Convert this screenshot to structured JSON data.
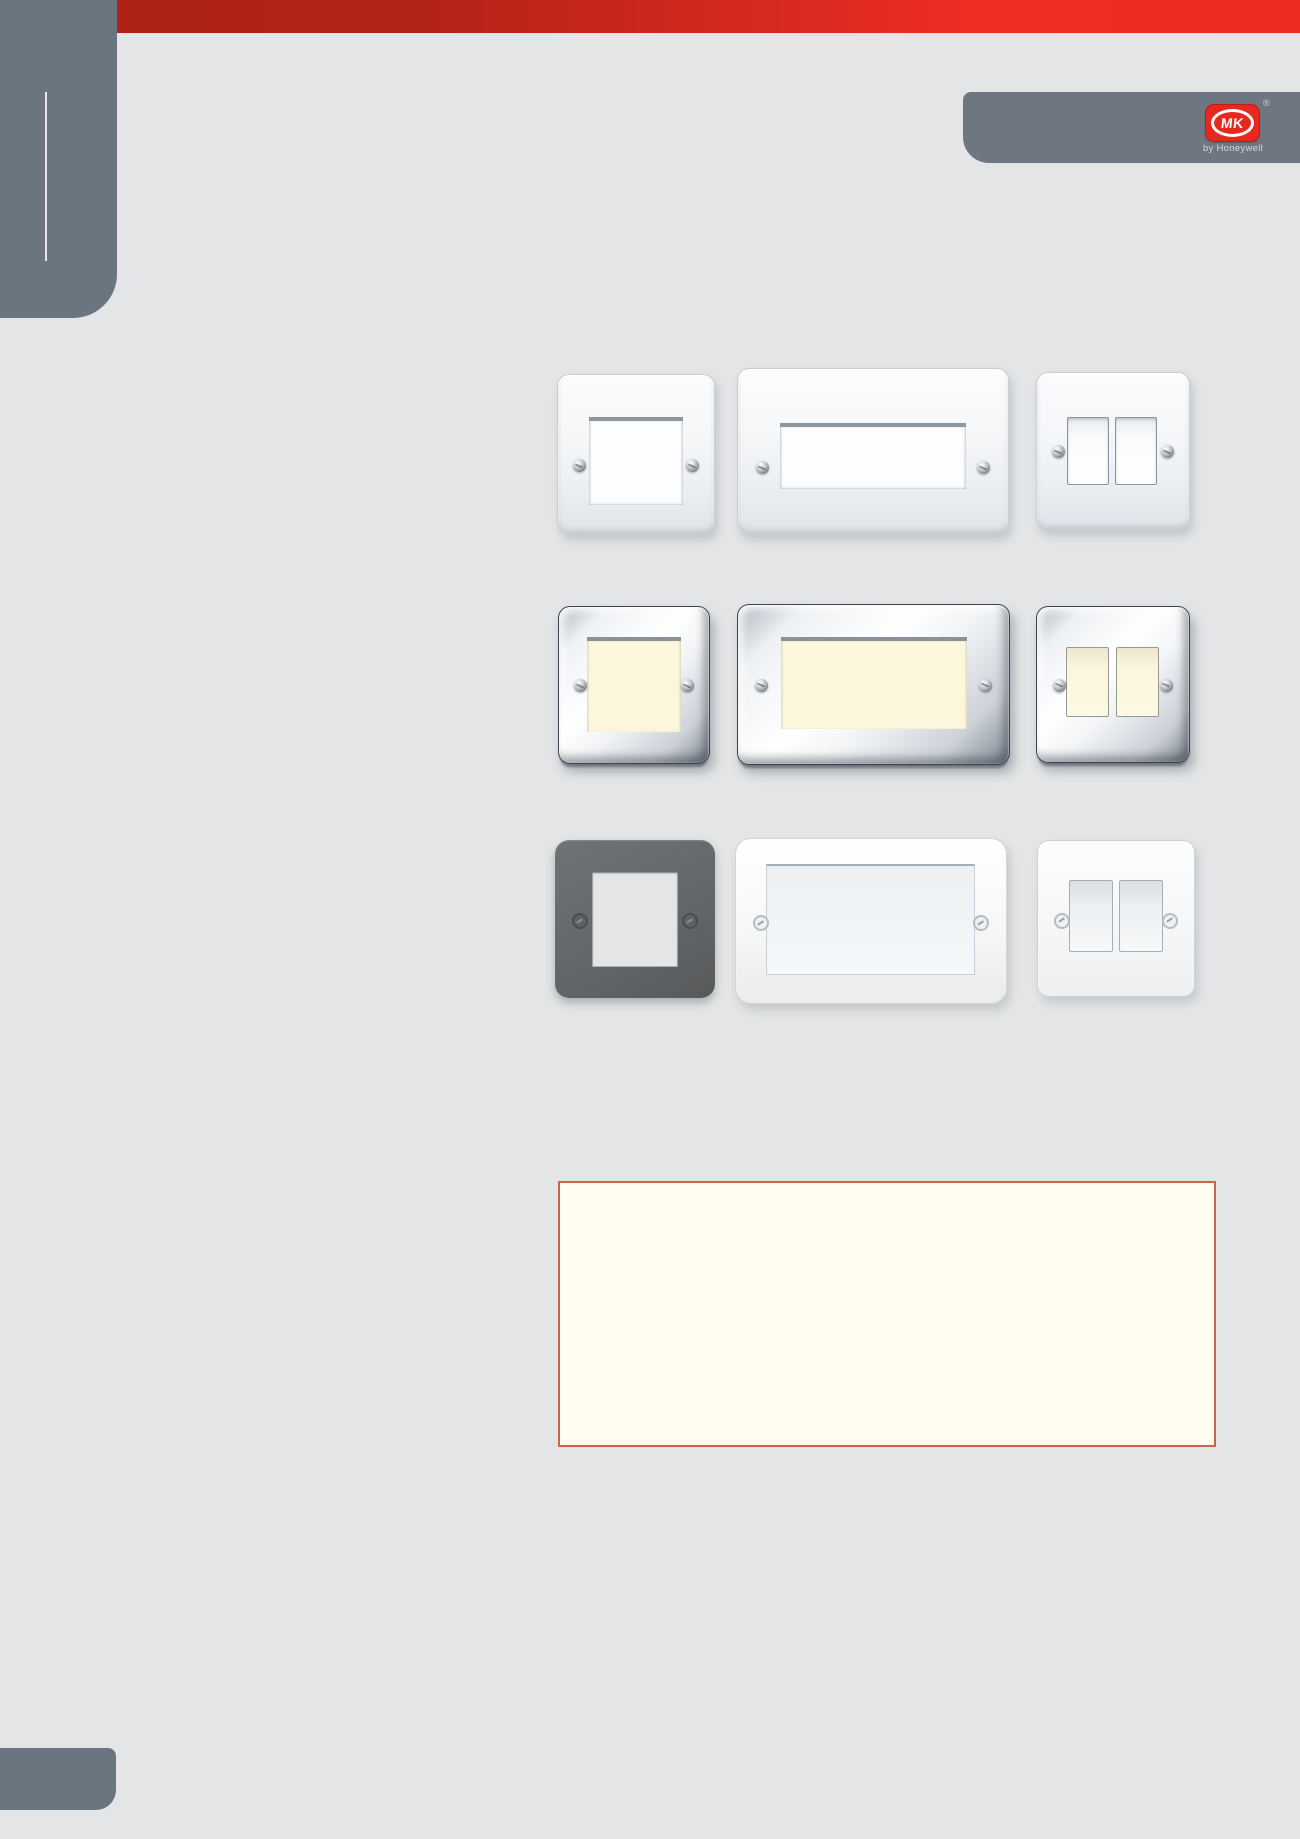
{
  "page": {
    "background": "#e3e5e6"
  },
  "header": {
    "red_bar_gradient_left": "#ae2217",
    "red_bar_gradient_right": "#ee2d23"
  },
  "sidebar": {
    "color": "#6b7580",
    "divider_color": "#ffffff"
  },
  "brand": {
    "tab_color": "#6d7681",
    "logo_text": "MK",
    "logo_color": "#e7281e",
    "registered_mark": "®",
    "byline": "by Honeywell"
  },
  "products": {
    "rows": [
      {
        "finish": "white-moulded",
        "aperture_color": "#fcfdfe",
        "items": [
          "1-gang-euro-frontplate",
          "2-gang-euro-frontplate",
          "2-gang-switch-plate"
        ]
      },
      {
        "finish": "polished-chrome",
        "aperture_color": "#fcf7dc",
        "items": [
          "1-gang-euro-frontplate",
          "2-gang-euro-frontplate",
          "2-gang-switch-plate"
        ]
      },
      {
        "finish": "graphite-and-white",
        "aperture_color": "#e3e5e6",
        "items": [
          "1-gang-grid-frontplate-graphite",
          "2-gang-euro-frontplate-white",
          "2-gang-switch-plate-white"
        ]
      }
    ]
  },
  "note_box": {
    "background": "#fffdf0",
    "border_color": "#d2604a"
  },
  "footer_tab": {
    "color": "#6b7580"
  }
}
